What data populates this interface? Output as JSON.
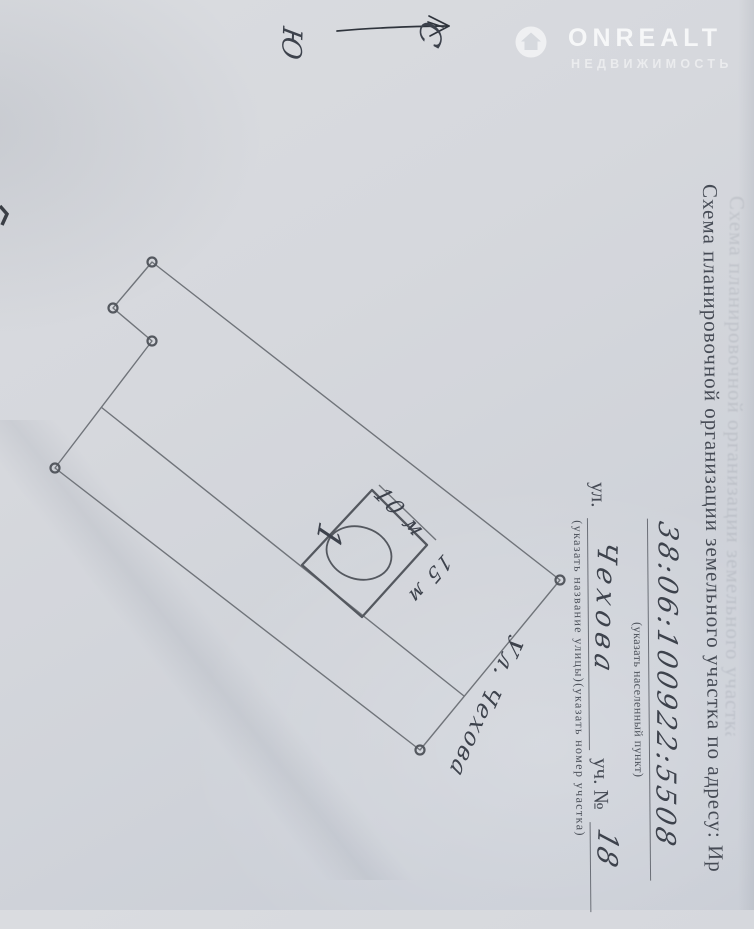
{
  "watermark": {
    "brand": "ONREALT",
    "subtitle": "НЕДВИЖИМОСТЬ",
    "logo_icon": "house-in-circle"
  },
  "compass": {
    "north_label": "С",
    "south_label": "Ю"
  },
  "form": {
    "title": "Схема планировочной организации земельного участка по адресу: Ир",
    "cadastral_number": "38:06:100922:5508",
    "settlement_caption": "(указать населенный пункт)",
    "street_label": "ул.",
    "street_value": "Чехова",
    "plot_label": "уч. №",
    "plot_value": "18",
    "street_plot_caption": "(указать название улицы)(указать номер участка)"
  },
  "sketch": {
    "house_number": "1",
    "dim_width": "10 м",
    "dim_depth": "15 м",
    "street_annotation": "Ул. Чехова"
  },
  "colors": {
    "paper": "#d3d6db",
    "pencil": "#6e7278",
    "ink": "#3d424c"
  }
}
